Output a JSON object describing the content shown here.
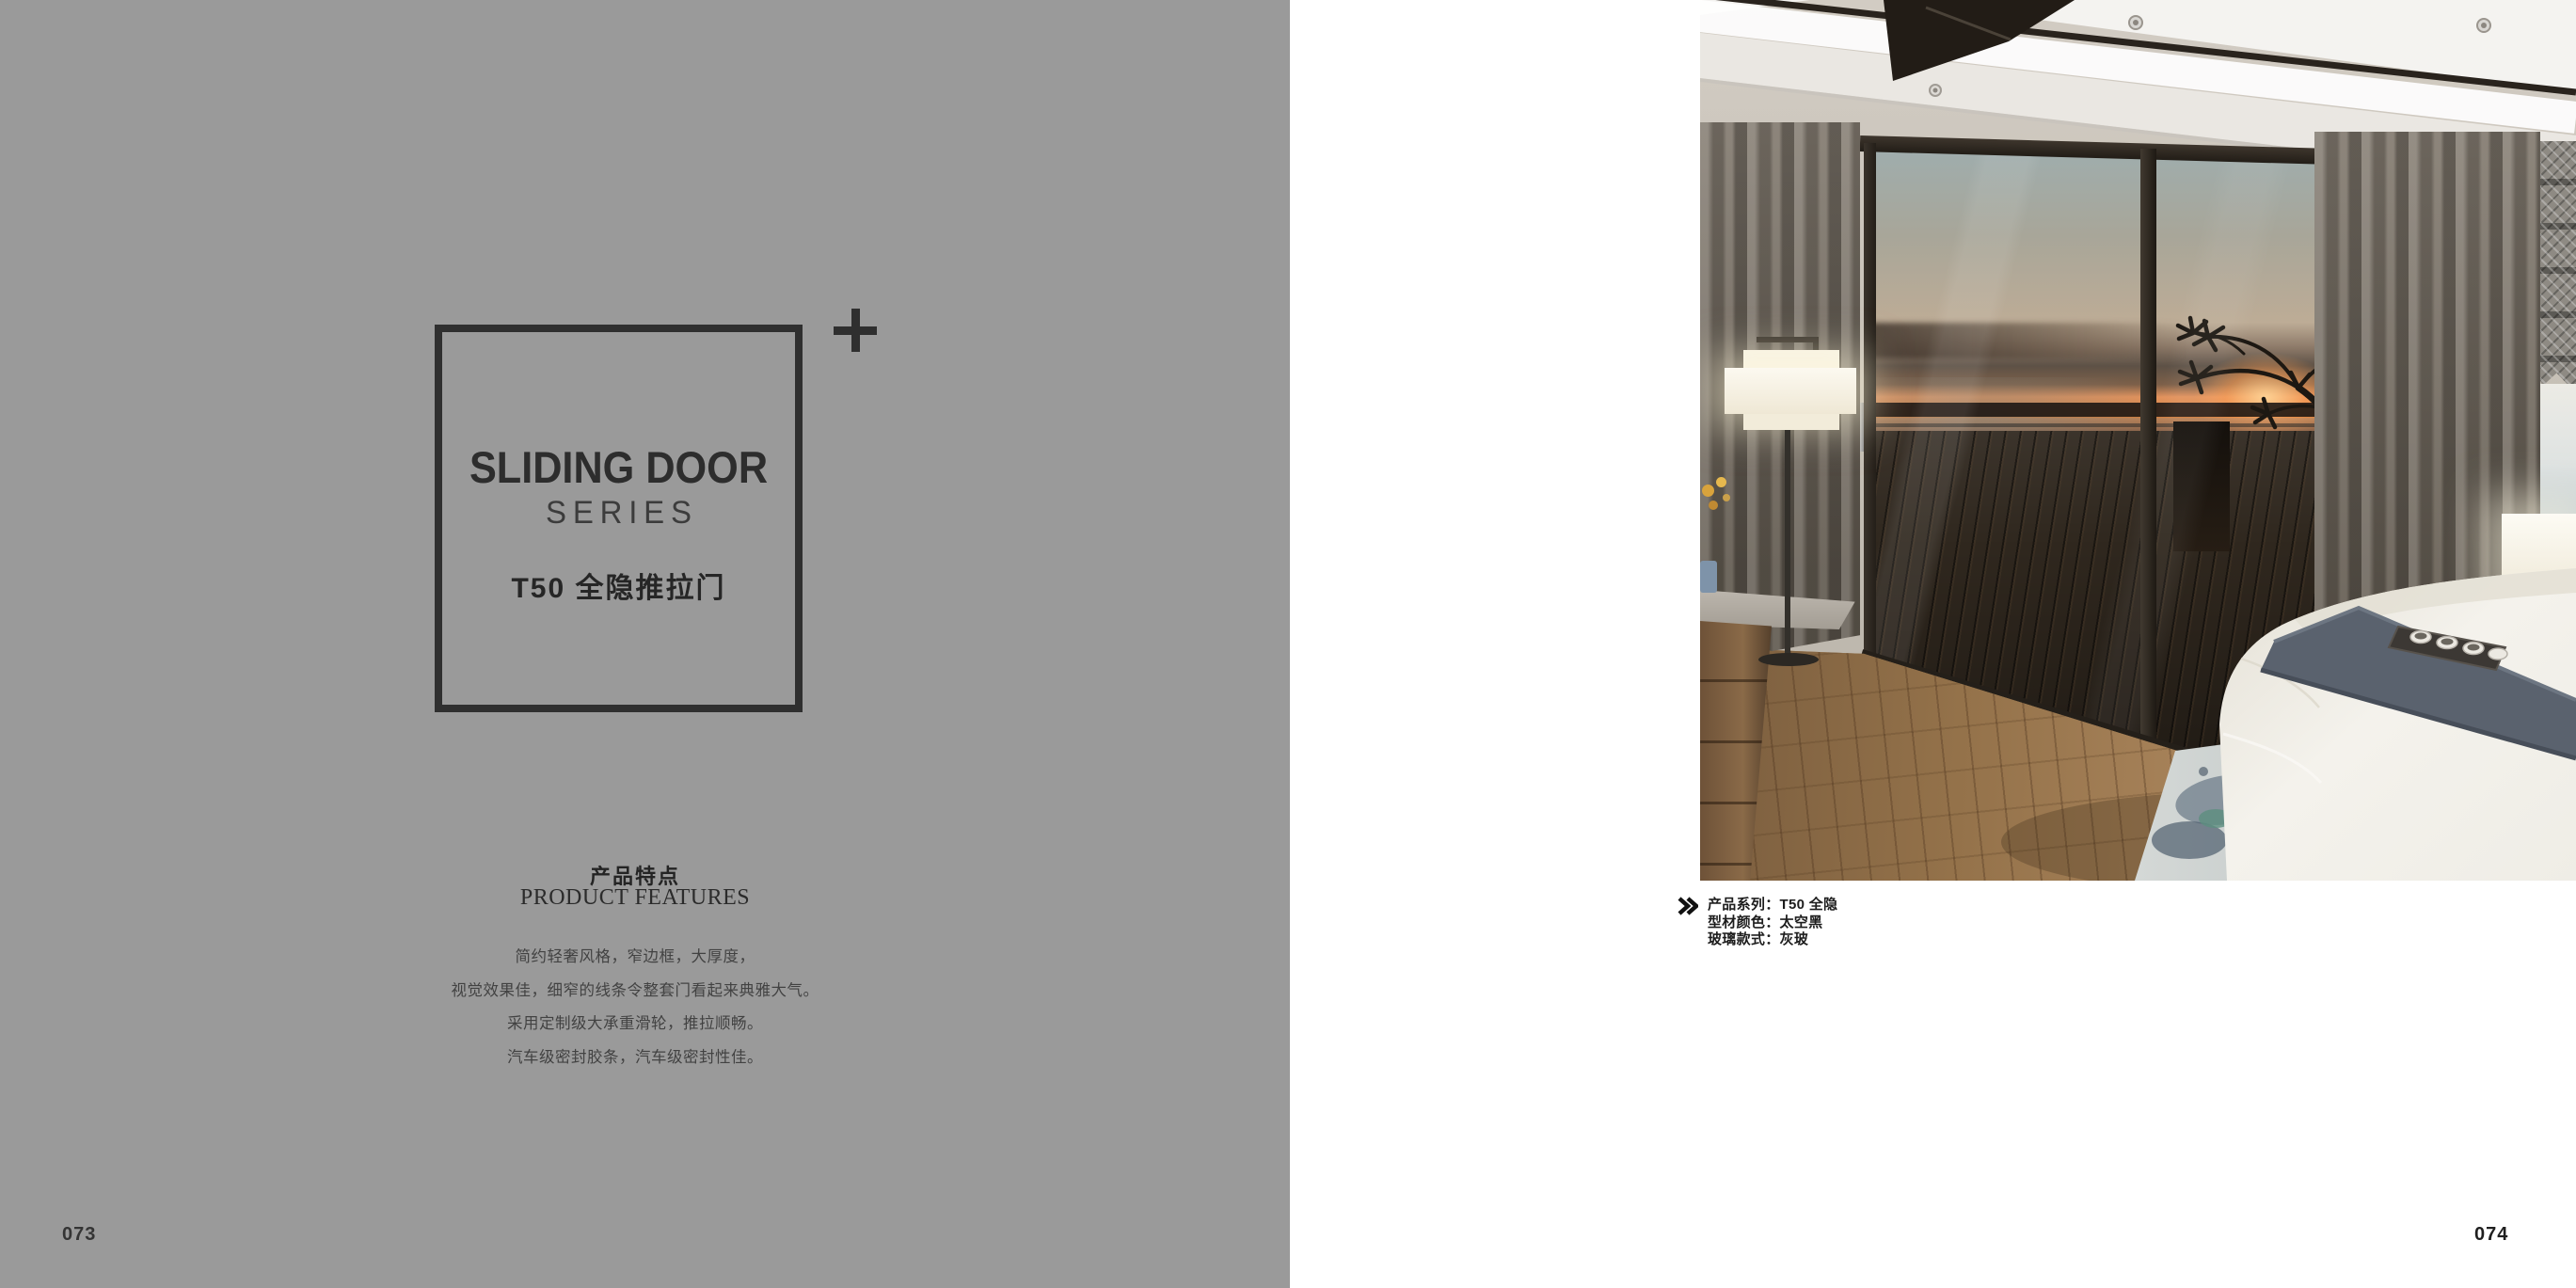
{
  "left_page": {
    "series_title_line1": "SLIDING DOOR",
    "series_title_line2": "SERIES",
    "series_subtitle_zh": "T50 全隐推拉门",
    "features_heading_zh": "产品特点",
    "features_heading_en": "PRODUCT FEATURES",
    "features": [
      "简约轻奢风格，窄边框，大厚度，",
      "视觉效果佳，细窄的线条令整套门看起来典雅大气。",
      "采用定制级大承重滑轮，推拉顺畅。",
      "汽车级密封胶条，汽车级密封性佳。"
    ],
    "page_number": "073"
  },
  "right_page": {
    "specs": [
      {
        "label": "产品系列：",
        "value": "T50 全隐"
      },
      {
        "label": "型材颜色：",
        "value": "太空黑"
      },
      {
        "label": "玻璃款式：",
        "value": "灰玻"
      }
    ],
    "page_number": "074"
  },
  "icons": {
    "plus_icon": "+",
    "double_chevron_icon": "»"
  },
  "colors": {
    "panel_gray": "#9a9a9a",
    "ink": "#2f2f2f",
    "body_text": "#424242"
  }
}
